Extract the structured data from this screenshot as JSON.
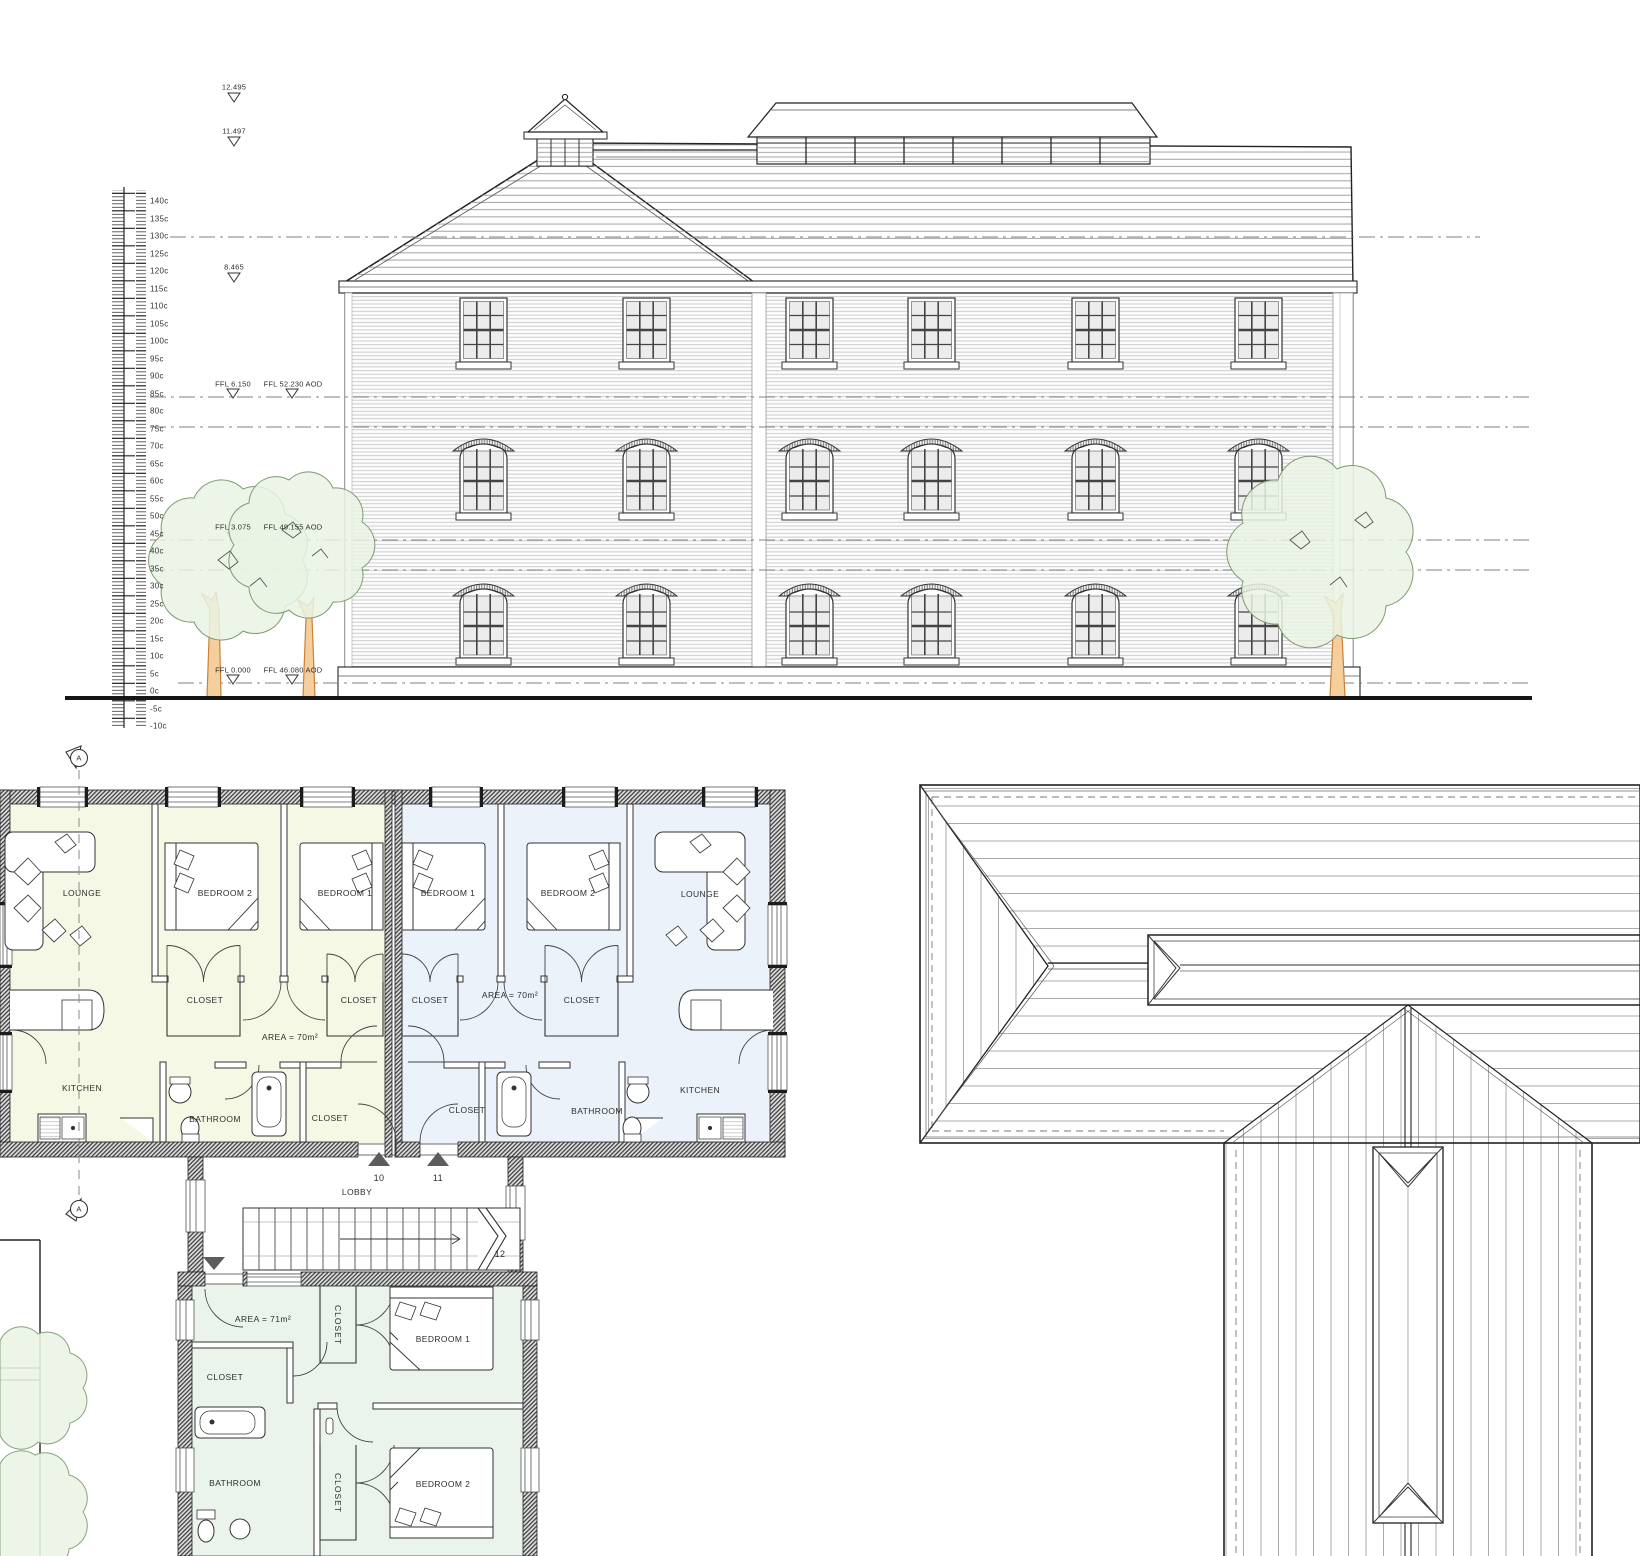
{
  "page": {
    "title": "Architectural drawing - side elevation, apartment floor plans and roof plan"
  },
  "elevation": {
    "spot_levels": [
      "12.495",
      "11.497",
      "8.465"
    ],
    "ffl_labels": [
      {
        "level": "FFL 6.150",
        "aod": "FFL 52.230 AOD"
      },
      {
        "level": "FFL 3.075",
        "aod": "FFL 49.155 AOD"
      },
      {
        "level": "FFL 0.000",
        "aod": "FFL 46.080 AOD"
      }
    ],
    "ruler_labels": [
      "140c",
      "135c",
      "130c",
      "125c",
      "120c",
      "115c",
      "110c",
      "105c",
      "100c",
      "95c",
      "90c",
      "85c",
      "80c",
      "75c",
      "70c",
      "65c",
      "60c",
      "55c",
      "50c",
      "45c",
      "40c",
      "35c",
      "30c",
      "25c",
      "20c",
      "15c",
      "10c",
      "5c",
      "0c",
      "-5c",
      "-10c"
    ]
  },
  "plan": {
    "unit_left": {
      "lounge": "LOUNGE",
      "bedroom2": "BEDROOM 2",
      "bedroom1": "BEDROOM 1",
      "closet_a": "CLOSET",
      "closet_b": "CLOSET",
      "area": "AREA = 70m²",
      "kitchen": "KITCHEN",
      "bathroom": "BATHROOM",
      "closet_c": "CLOSET"
    },
    "unit_right": {
      "bedroom1": "BEDROOM 1",
      "bedroom2": "BEDROOM 2",
      "lounge": "LOUNGE",
      "closet_a": "CLOSET",
      "closet_b": "CLOSET",
      "area": "AREA = 70m²",
      "closet_c": "CLOSET",
      "bathroom": "BATHROOM",
      "kitchen": "KITCHEN"
    },
    "lobby": {
      "label": "LOBBY",
      "door_left": "10",
      "door_right": "11",
      "stair": "12"
    },
    "unit_lower": {
      "area": "AREA = 71m²",
      "closet_top": "CLOSET",
      "bedroom1": "BEDROOM 1",
      "closet_left": "CLOSET",
      "bathroom": "BATHROOM",
      "closet_mid": "CLOSET",
      "bedroom2": "BEDROOM 2"
    },
    "section_marker": "A"
  },
  "colors": {
    "unit_left_fill": "#f4f8e4",
    "unit_right_fill": "#ebf2f9",
    "unit_lower_fill": "#eaf4ea",
    "tree_canopy": "#e9f3e3",
    "tree_trunk": "#f5cf9b",
    "line": "#222222"
  }
}
